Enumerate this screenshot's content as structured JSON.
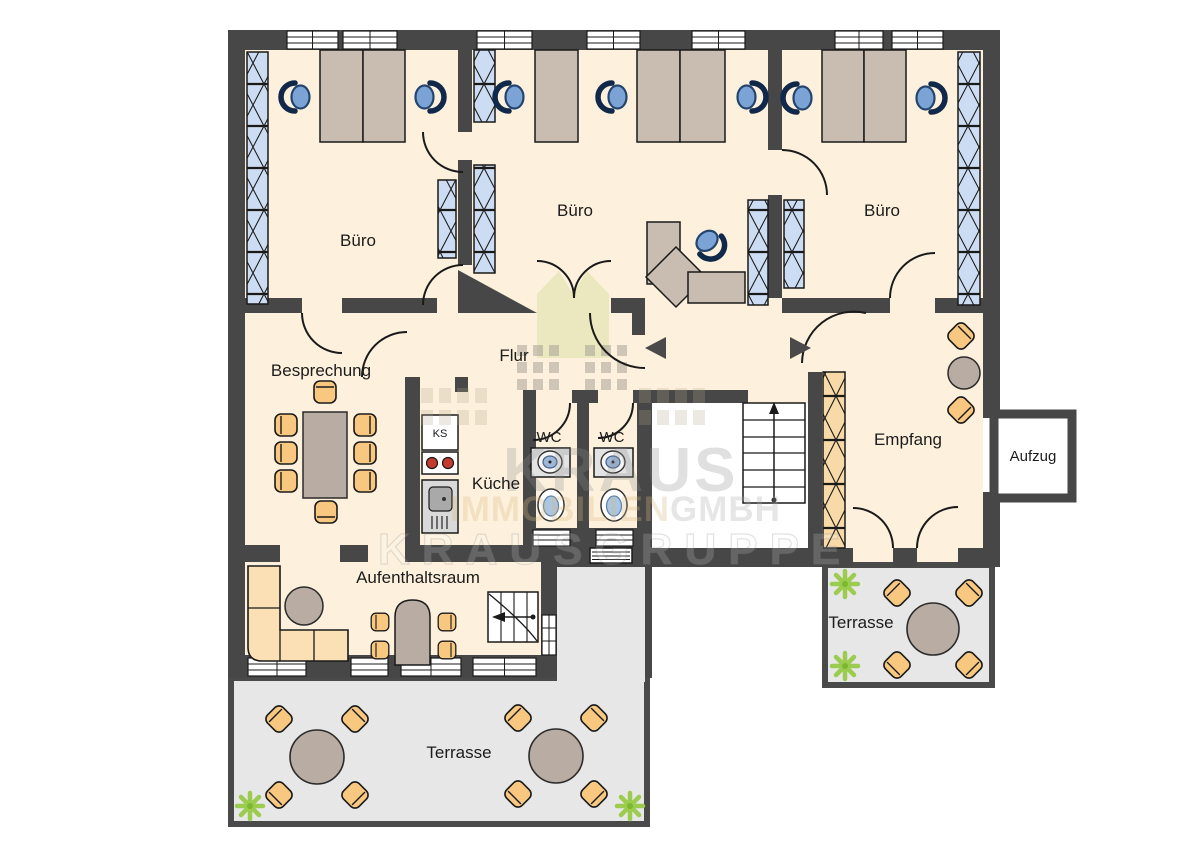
{
  "watermark": {
    "brand": "KRAUS",
    "company_a": "IMMOBILIEN",
    "company_b": "GMBH",
    "group": "KRAUSGRUPPE"
  },
  "rooms": {
    "office_left": "Büro",
    "office_middle": "Büro",
    "office_right": "Büro",
    "hallway": "Flur",
    "meeting": "Besprechung",
    "kitchen": "Küche",
    "kitchen_unit": "KS",
    "wc_left": "WC",
    "wc_right": "WC",
    "lounge": "Aufenthaltsraum",
    "reception": "Empfang",
    "elevator": "Aufzug",
    "terrace_main": "Terrasse",
    "terrace_side": "Terrasse"
  },
  "colors": {
    "wall": "#474747",
    "floor": "#fdf1dd",
    "terrace": "#e7e7e7",
    "stairwell": "#ffffff",
    "cabinet_blue": "#ccdcf2",
    "cabinet_orange": "#f8d9a8",
    "furniture_orange": "#f9c880",
    "desk_taupe": "#c9bcb1",
    "office_chair_blue": "#7ca3d6",
    "table_gray": "#b9aca2",
    "plant_green": "#9ccc4f",
    "burner_red": "#c23b2e"
  }
}
